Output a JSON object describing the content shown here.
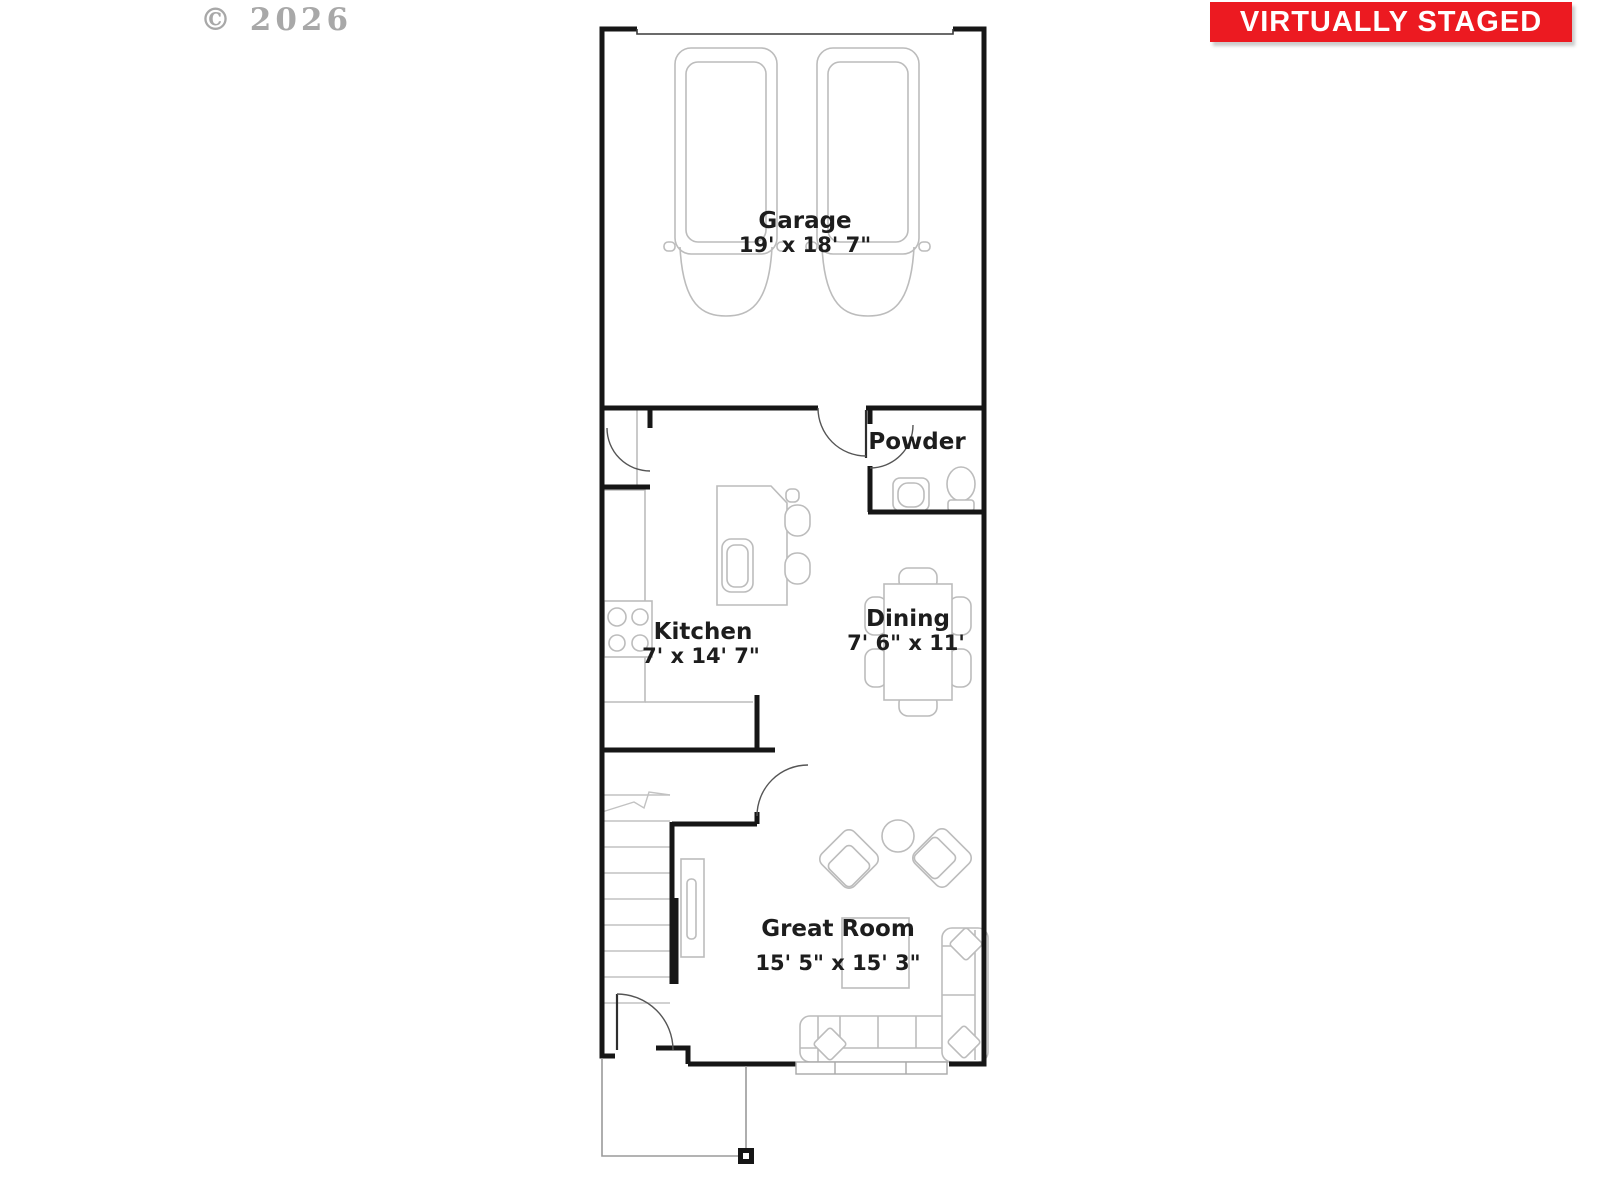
{
  "watermark": {
    "text": "© 2026"
  },
  "banner": {
    "text": "VIRTUALLY STAGED",
    "bg_color": "#ec1a21",
    "text_color": "#ffffff"
  },
  "rooms": {
    "garage": {
      "name": "Garage",
      "dims": "19' x 18' 7\""
    },
    "powder": {
      "name": "Powder"
    },
    "kitchen": {
      "name": "Kitchen",
      "dims": "7' x 14' 7\""
    },
    "dining": {
      "name": "Dining",
      "dims": "7' 6\" x 11'"
    },
    "great_room": {
      "name": "Great Room",
      "dims": "15' 5\" x 15' 3\""
    }
  },
  "colors": {
    "wall": "#161616",
    "furniture_line": "#bcbcbc",
    "label_text": "#1d1d1d",
    "watermark_text": "#9a9a9a"
  }
}
